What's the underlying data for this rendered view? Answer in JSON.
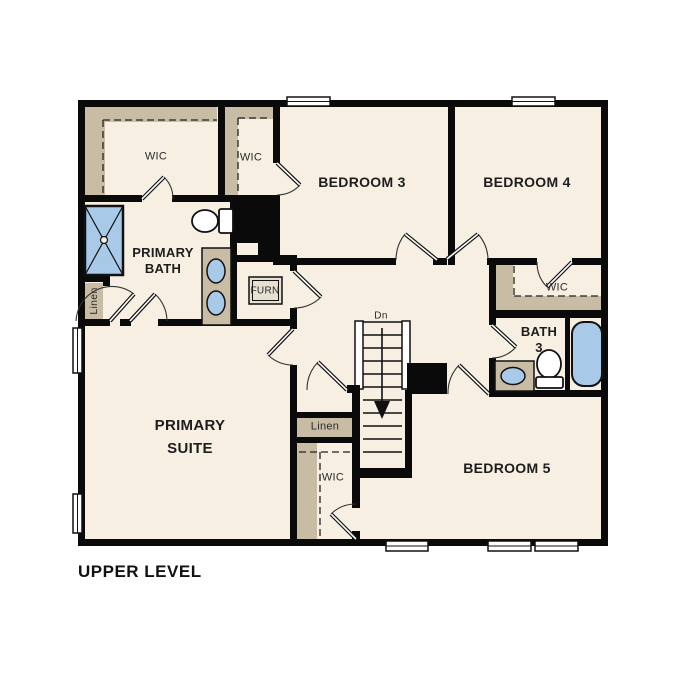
{
  "page": {
    "title": "UPPER LEVEL"
  },
  "colors": {
    "page_bg": "#ffffff",
    "floor": "#f6efe2",
    "shelf_tan": "#c8bca4",
    "fixture_blue": "#a8cae8",
    "wall_black": "#0a0a0a",
    "furnace_fill": "#e6e0d2",
    "text": "#1d1d1d"
  },
  "rooms": {
    "bedroom_3": {
      "label": "BEDROOM 3"
    },
    "bedroom_4": {
      "label": "BEDROOM 4"
    },
    "bedroom_5": {
      "label": "BEDROOM 5"
    },
    "primary_suite": {
      "line1": "PRIMARY",
      "line2": "SUITE"
    },
    "primary_bath": {
      "line1": "PRIMARY",
      "line2": "BATH"
    },
    "bath_3": {
      "line1": "BATH",
      "line2": "3"
    },
    "wic_primary": {
      "label": "WIC"
    },
    "wic_bedroom_3": {
      "label": "WIC"
    },
    "wic_bedroom_4": {
      "label": "WIC"
    },
    "wic_bedroom_5": {
      "label": "WIC"
    },
    "linen_primary_bath": {
      "label": "Linen"
    },
    "linen_hall": {
      "label": "Linen"
    },
    "furnace_closet": {
      "label": "FURN"
    },
    "stairs": {
      "down_label": "Dn"
    }
  }
}
